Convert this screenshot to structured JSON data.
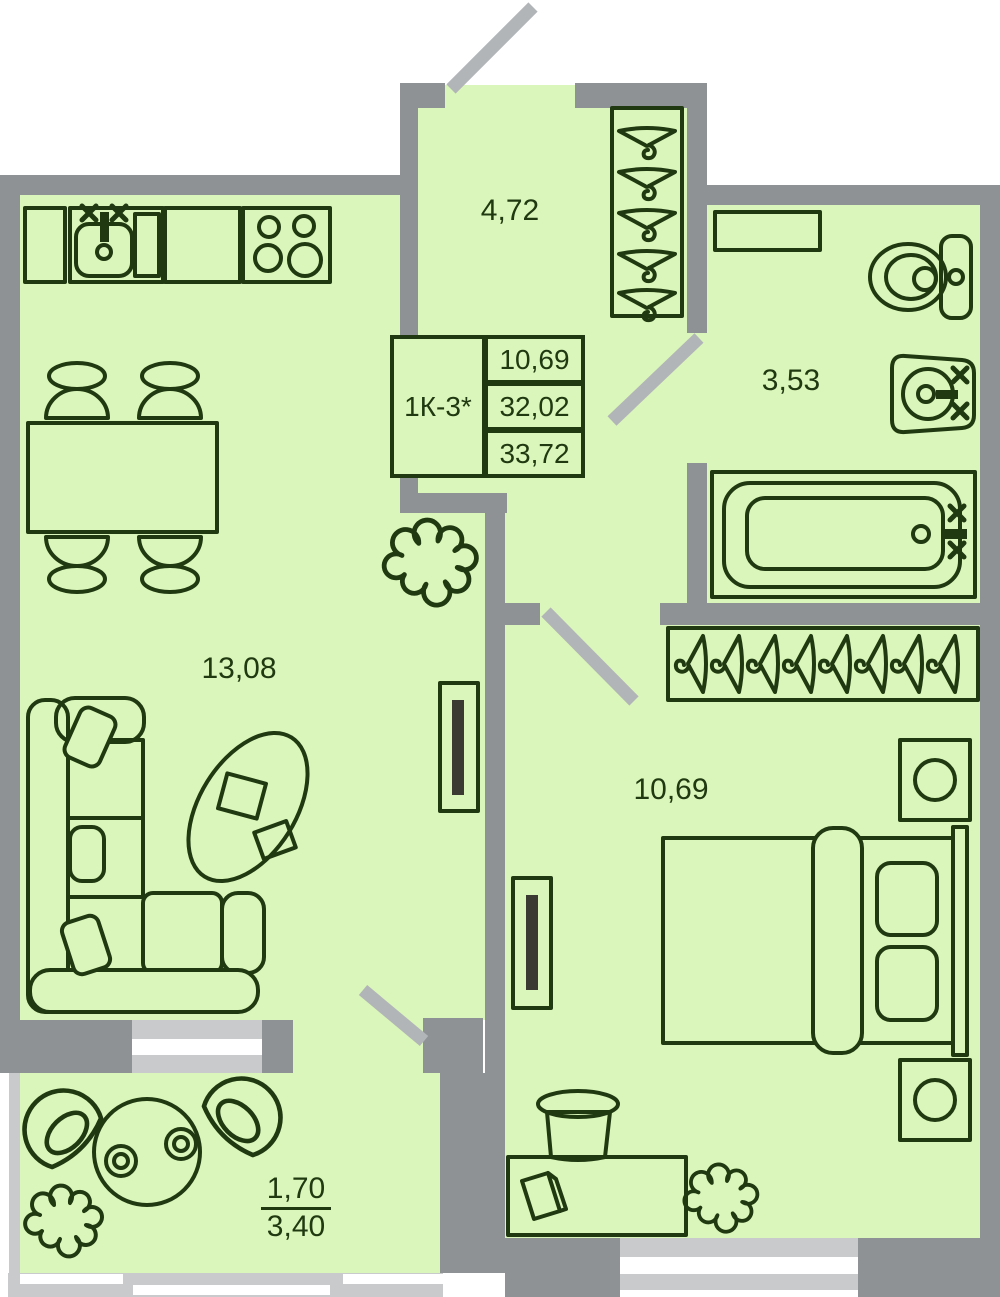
{
  "floorplan": {
    "unit_code": "1К-3*",
    "areas": {
      "area_living": "10,69",
      "area_apartment": "32,02",
      "area_total": "33,72"
    },
    "rooms": {
      "hall": {
        "area": "4,72"
      },
      "bathroom": {
        "area": "3,53"
      },
      "kitchen_living": {
        "area": "13,08"
      },
      "bedroom": {
        "area": "10,69"
      },
      "balcony": {
        "area_coefficient": "1,70",
        "area_full": "3,40"
      }
    },
    "colors": {
      "floor": "#dbf6ba",
      "wall": "#8f9295",
      "door_leaf": "#b2b5b8",
      "window": "#c8cacc",
      "line": "#203911"
    }
  }
}
